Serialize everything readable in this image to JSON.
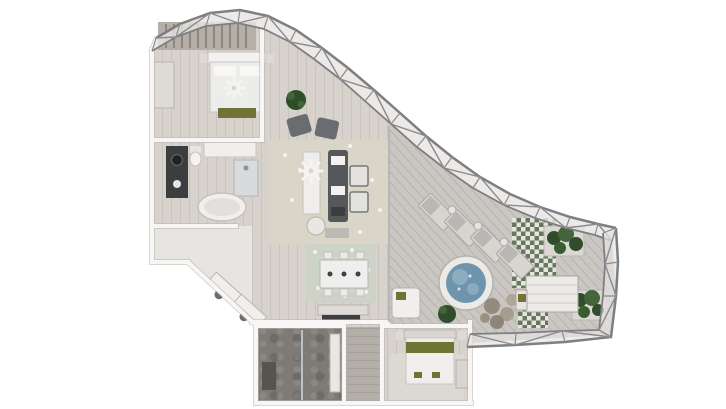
{
  "scene": {
    "description": "Aerial 3D cutaway floor plan rendering of a penthouse apartment with a curved steel-truss glass facade and a wraparound sun terrace",
    "view": "top-down axonometric render",
    "visible_text": "none"
  },
  "palette": {
    "background": "#ffffff",
    "floor_wood": "#d7d2cc",
    "deck": "#cac7c3",
    "wall": "#f7f6f4",
    "wall_shadow": "#b9b5b1",
    "truss": "#7e7f82",
    "glass": "#e7e4e1",
    "marble": "#e7e5e1",
    "stone_dark": "#7e7a75",
    "dark_furniture": "#3b3d3f",
    "sofa": "#55585a",
    "armchair": "#6a6d6f",
    "olive": "#6f7434",
    "plant_dark": "#2f4d2b",
    "plant_light": "#44653a",
    "water": "#6f94ad",
    "water_light": "#a7c0cf",
    "pool_rim": "#eceae6",
    "tile_green": "#5d7154",
    "rug_living": "#d9d5c9",
    "rug_dining": "#ced3c8",
    "rug_bedroom2": "#dcd8d2",
    "closet_shelving": "#b6afa7",
    "rock": "#9a9184"
  },
  "rooms": [
    {
      "id": "walk-in-closet",
      "label": "Walk-in closet"
    },
    {
      "id": "master-bedroom",
      "label": "Master bedroom"
    },
    {
      "id": "master-bathroom",
      "label": "Master bathroom"
    },
    {
      "id": "foyer",
      "label": "Foyer / hallway"
    },
    {
      "id": "living-room",
      "label": "Living room"
    },
    {
      "id": "dining-area",
      "label": "Dining area"
    },
    {
      "id": "bathroom-2",
      "label": "Second bathroom"
    },
    {
      "id": "hallway-2",
      "label": "Rear hallway"
    },
    {
      "id": "bedroom-2",
      "label": "Guest bedroom"
    },
    {
      "id": "terrace",
      "label": "Wraparound terrace"
    }
  ],
  "furnishings": {
    "truss": "Curved steel facade truss with glazing",
    "closet": "Wardrobe shelving with hanging clothes",
    "bed_master": "King bed with olive bench",
    "dresser": "Bedroom dresser",
    "ceiling_fan": "Ceiling fan",
    "vanity": "Dark stone vanity with round sink",
    "bath_counter": "Bathroom counter",
    "bathtub": "Freestanding oval bathtub",
    "shower": "Glass walk-in shower",
    "toilet": "Toilet",
    "sofa": "Dark sectional sofa",
    "armchairs": "Pair of lounge armchairs",
    "club_chairs": "Two upholstered club chairs",
    "island_table": "Long white console / island table",
    "coffee_table": "Round coffee table",
    "potted_plant": "Potted plant",
    "dining_table": "Dining table with six chairs",
    "pendants": "Pendant lights",
    "sideboard": "Dark-topped sideboard",
    "angled_desks": "Console desks along angled wall",
    "shower_bench": "Shower bench",
    "vanity2": "Guest bath vanity",
    "bed_guest": "Guest bed with olive runner",
    "nightstands": "Nightstands",
    "guest_dresser": "Guest dresser",
    "loungers": "Row of four sun loungers",
    "side_tables": "Lounger side tables",
    "jacuzzi": "Round mosaic plunge pool",
    "rocks": "Stone seating cluster",
    "planters": "Terrace planters with shrubs",
    "outdoor_table": "Outdoor dining table with bench",
    "daybed": "Outdoor daybed",
    "tile_decking": "Green patterned tile decking"
  }
}
